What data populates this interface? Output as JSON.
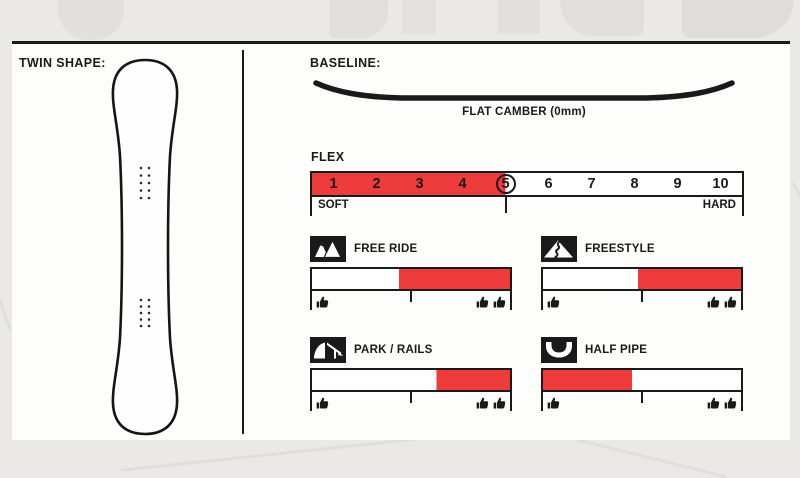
{
  "theme": {
    "red": "#ee3b3c",
    "ink": "#1a1a1a",
    "panel": "#fdfdfc",
    "background": "#eae9e6"
  },
  "left_panel": {
    "title": "TWIN SHAPE:",
    "board_icon": "twin-snowboard-outline"
  },
  "baseline": {
    "title": "BASELINE:",
    "profile_icon": "flat-camber-profile",
    "caption": "FLAT CAMBER (0mm)"
  },
  "flex": {
    "title": "FLEX",
    "values": [
      "1",
      "2",
      "3",
      "4",
      "5",
      "6",
      "7",
      "8",
      "9",
      "10"
    ],
    "selected_value": "5",
    "fill_start_pct": 0,
    "fill_end_pct": 45,
    "left_label": "SOFT",
    "right_label": "HARD"
  },
  "ratings": [
    {
      "label": "FREE RIDE",
      "icon": "freeride-mountains-icon",
      "fill_start_pct": 44,
      "fill_end_pct": 100
    },
    {
      "label": "FREESTYLE",
      "icon": "freestyle-slope-icon",
      "fill_start_pct": 48,
      "fill_end_pct": 100
    },
    {
      "label": "PARK / RAILS",
      "icon": "park-rails-icon",
      "fill_start_pct": 63,
      "fill_end_pct": 100
    },
    {
      "label": "HALF PIPE",
      "icon": "halfpipe-icon",
      "fill_start_pct": 0,
      "fill_end_pct": 45
    }
  ],
  "rating_scale": {
    "low_marker": "one-thumb-up",
    "high_marker": "two-thumbs-up"
  }
}
